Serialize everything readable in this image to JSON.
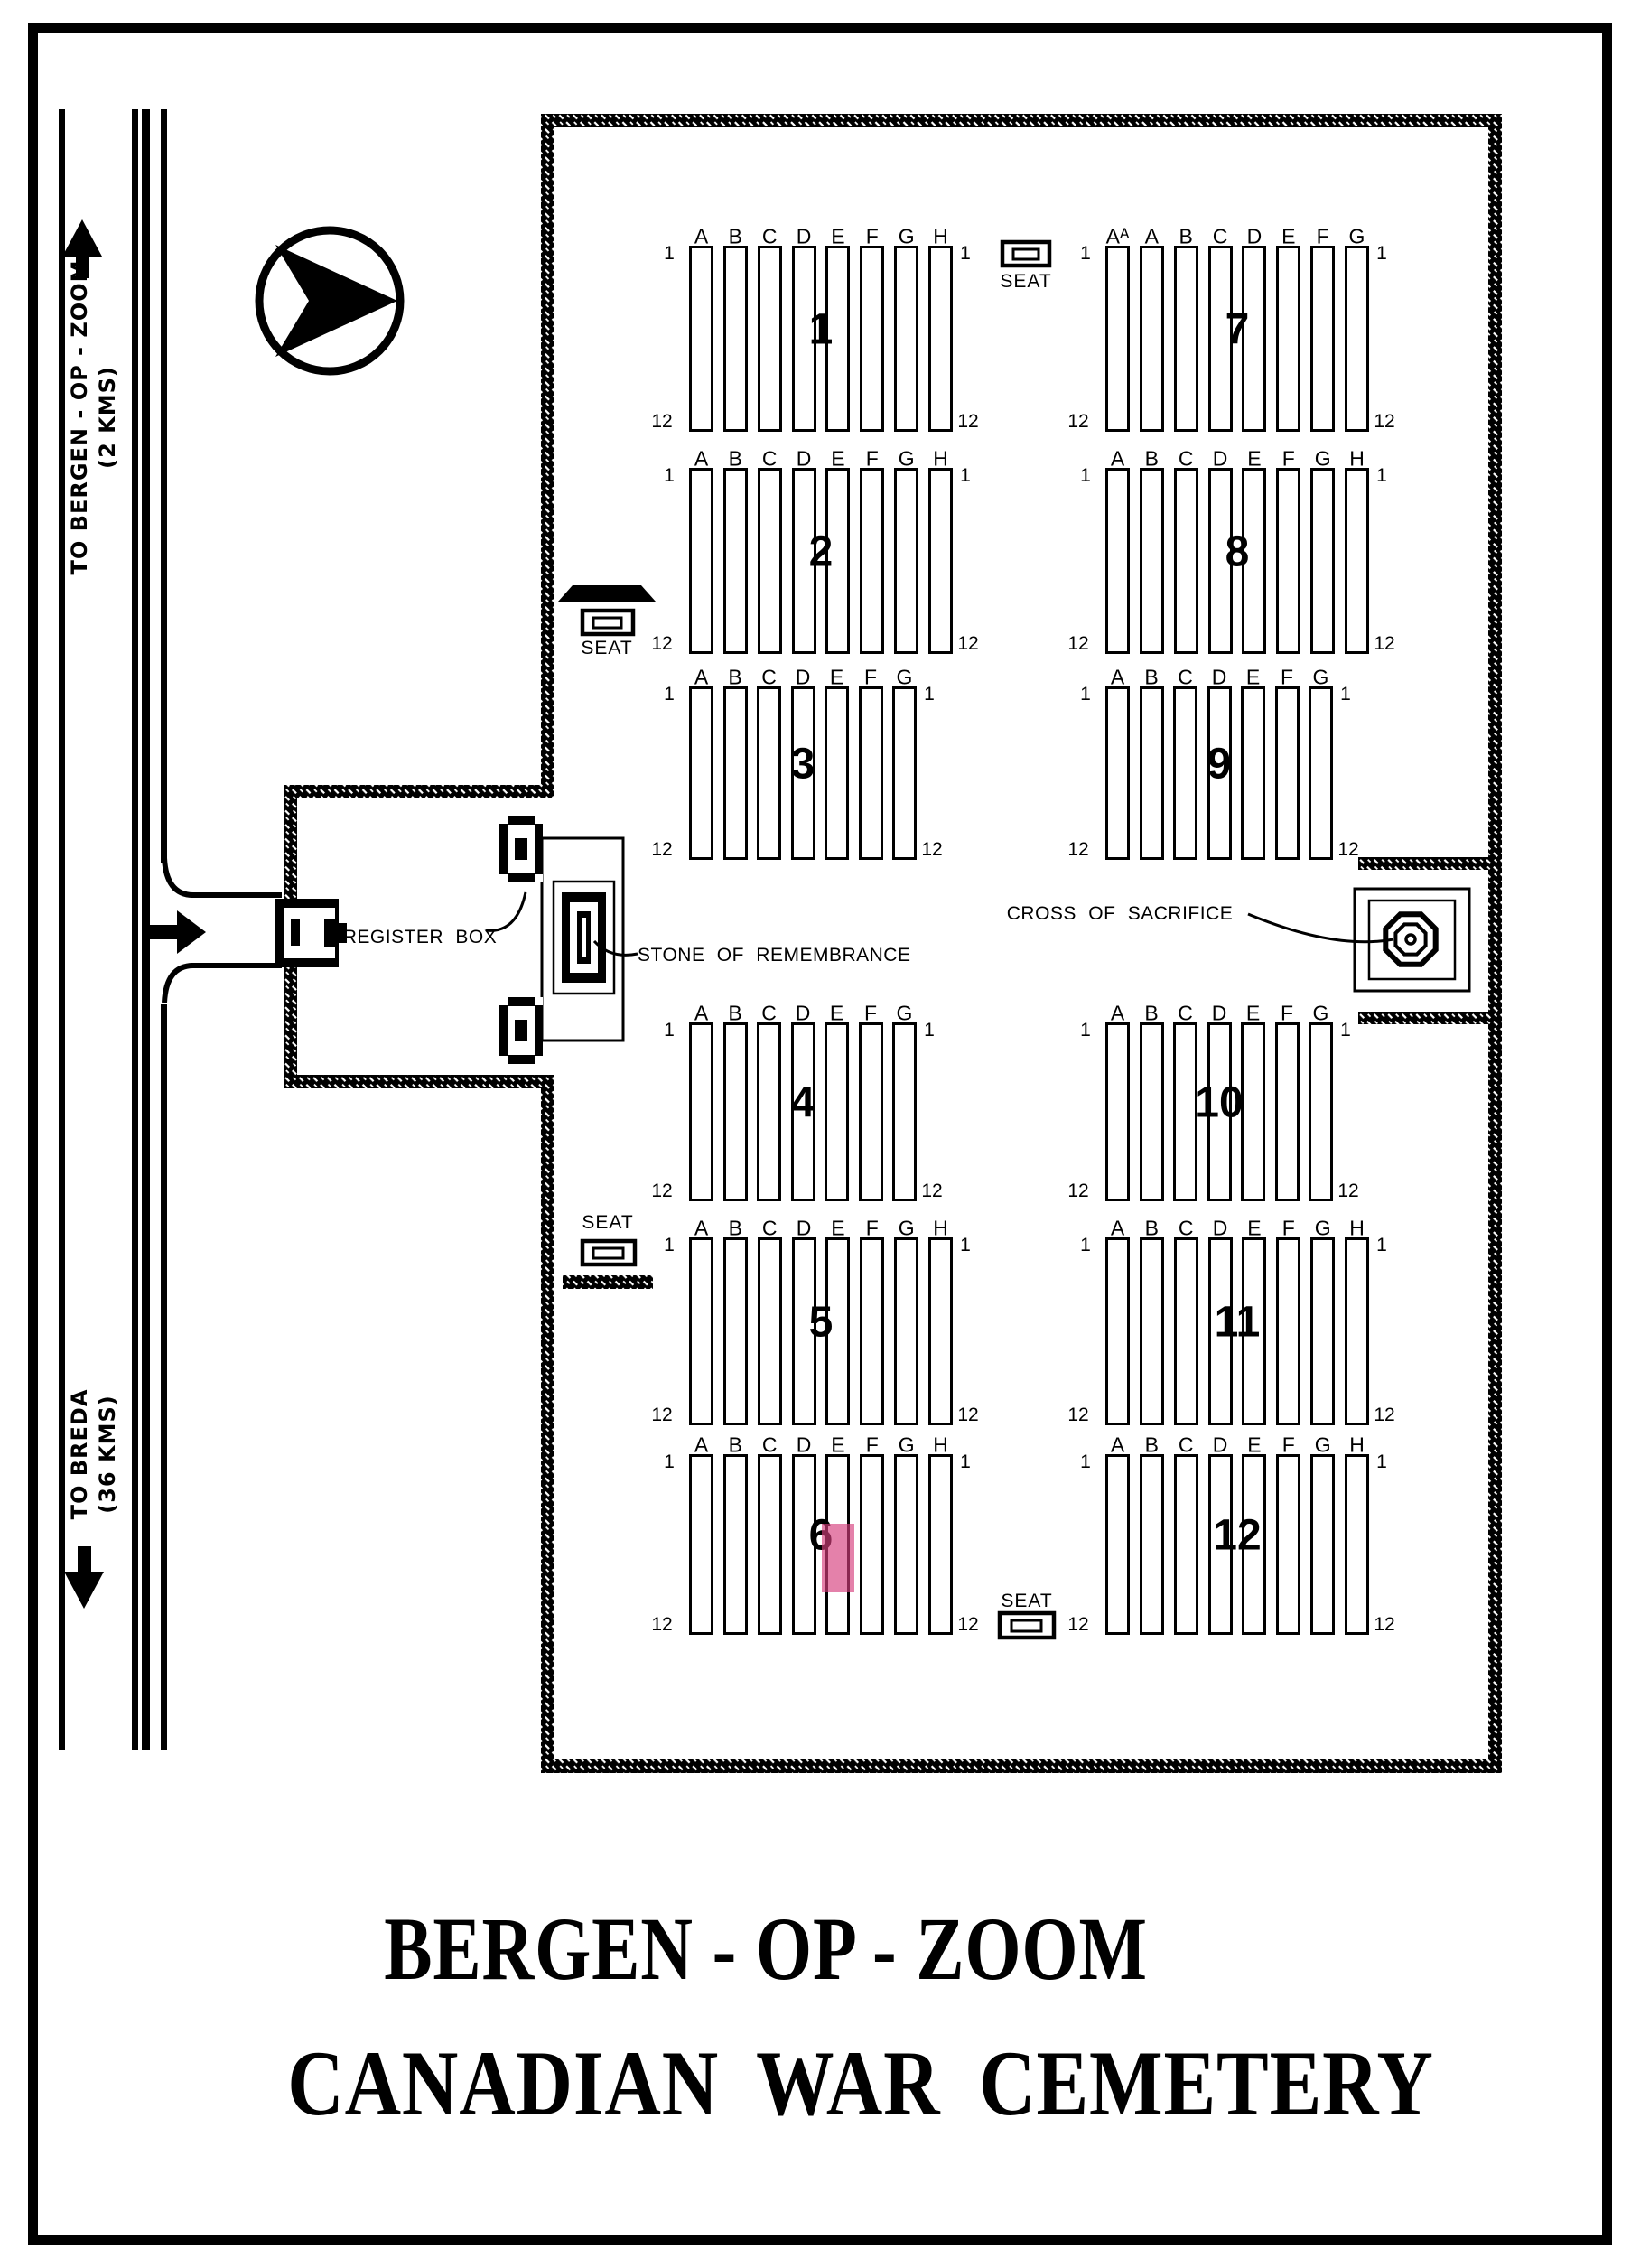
{
  "page": {
    "title_line1": "BERGEN - OP - ZOOM",
    "title_line2": "CANADIAN  WAR  CEMETERY"
  },
  "road": {
    "to_bergen_line1": "TO BERGEN - OP - ZOOM",
    "to_bergen_line2": "(2 KMS)",
    "to_breda_line1": "TO BREDA",
    "to_breda_line2": "(36 KMS)"
  },
  "landmarks": {
    "register_box": "REGISTER BOX",
    "stone": "STONE OF REMEMBRANCE",
    "cross": "CROSS OF SACRIFICE",
    "seat": "SEAT"
  },
  "highlight_color": "rgba(213,62,125,0.65)",
  "sections": [
    {
      "number": "1",
      "group": "left",
      "band": 0,
      "col_letters": [
        "A",
        "B",
        "C",
        "D",
        "E",
        "F",
        "G",
        "H"
      ],
      "row_start": "1",
      "row_end": "12"
    },
    {
      "number": "2",
      "group": "left",
      "band": 1,
      "col_letters": [
        "A",
        "B",
        "C",
        "D",
        "E",
        "F",
        "G",
        "H"
      ],
      "row_start": "1",
      "row_end": "12"
    },
    {
      "number": "3",
      "group": "left",
      "band": 2,
      "col_letters": [
        "A",
        "B",
        "C",
        "D",
        "E",
        "F",
        "G"
      ],
      "row_start": "1",
      "row_end": "12"
    },
    {
      "number": "4",
      "group": "left",
      "band": 3,
      "col_letters": [
        "A",
        "B",
        "C",
        "D",
        "E",
        "F",
        "G"
      ],
      "row_start": "1",
      "row_end": "12"
    },
    {
      "number": "5",
      "group": "left",
      "band": 4,
      "col_letters": [
        "A",
        "B",
        "C",
        "D",
        "E",
        "F",
        "G",
        "H"
      ],
      "row_start": "1",
      "row_end": "12"
    },
    {
      "number": "6",
      "group": "left",
      "band": 5,
      "col_letters": [
        "A",
        "B",
        "C",
        "D",
        "E",
        "F",
        "G",
        "H"
      ],
      "row_start": "1",
      "row_end": "12",
      "highlight": {
        "column": "E",
        "row_from": 5,
        "row_to": 9
      }
    },
    {
      "number": "7",
      "group": "right",
      "band": 0,
      "col_letters": [
        "Aᴬ",
        "A",
        "B",
        "C",
        "D",
        "E",
        "F",
        "G"
      ],
      "row_start": "1",
      "row_end": "12"
    },
    {
      "number": "8",
      "group": "right",
      "band": 1,
      "col_letters": [
        "A",
        "B",
        "C",
        "D",
        "E",
        "F",
        "G",
        "H"
      ],
      "row_start": "1",
      "row_end": "12"
    },
    {
      "number": "9",
      "group": "right",
      "band": 2,
      "col_letters": [
        "A",
        "B",
        "C",
        "D",
        "E",
        "F",
        "G"
      ],
      "row_start": "1",
      "row_end": "12"
    },
    {
      "number": "10",
      "group": "right",
      "band": 3,
      "col_letters": [
        "A",
        "B",
        "C",
        "D",
        "E",
        "F",
        "G"
      ],
      "row_start": "1",
      "row_end": "12"
    },
    {
      "number": "11",
      "group": "right",
      "band": 4,
      "col_letters": [
        "A",
        "B",
        "C",
        "D",
        "E",
        "F",
        "G",
        "H"
      ],
      "row_start": "1",
      "row_end": "12"
    },
    {
      "number": "12",
      "group": "right",
      "band": 5,
      "col_letters": [
        "A",
        "B",
        "C",
        "D",
        "E",
        "F",
        "G",
        "H"
      ],
      "row_start": "1",
      "row_end": "12"
    }
  ]
}
